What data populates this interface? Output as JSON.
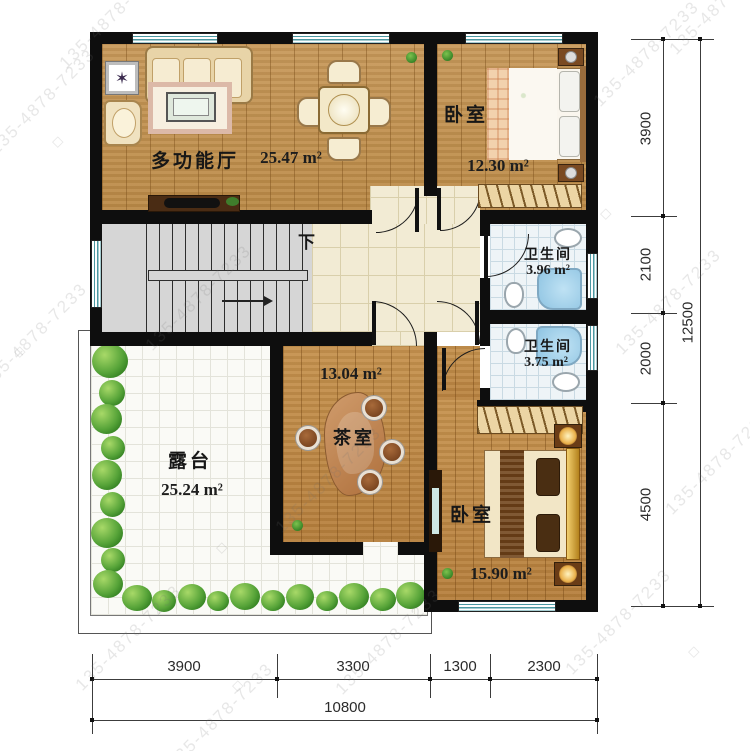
{
  "watermark": {
    "text": "135-4878-7233",
    "symbol": "◇"
  },
  "plan": {
    "hall": {
      "name": "多功能厅",
      "area": "25.47 m²"
    },
    "bedroom_top": {
      "name": "卧室",
      "area": "12.30 m²"
    },
    "bath_top": {
      "name": "卫生间",
      "area": "3.96 m²"
    },
    "bath_bottom": {
      "name": "卫生间",
      "area": "3.75 m²"
    },
    "tearoom": {
      "name": "茶室",
      "area": "13.04 m²"
    },
    "terrace": {
      "name": "露台",
      "area": "25.24 m²"
    },
    "bedroom_bottom": {
      "name": "卧室",
      "area": "15.90 m²"
    },
    "stair_label": "下"
  },
  "dimensions": {
    "right": [
      "3900",
      "2100",
      "2000",
      "4500"
    ],
    "right_total": "12500",
    "bottom": [
      "3900",
      "3300",
      "1300",
      "2300"
    ],
    "bottom_total": "10800"
  }
}
